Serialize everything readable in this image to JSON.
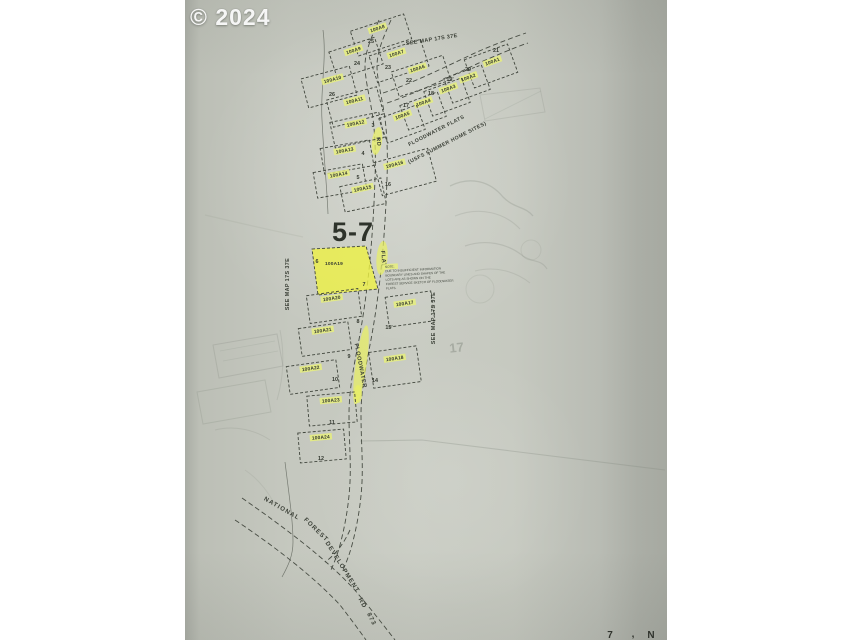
{
  "watermark": "© 2024",
  "colors": {
    "highlight": "#e6ee7c",
    "bright_highlight": "#edf143",
    "paper": "#c6c9c0",
    "ink": "#41463d"
  },
  "map": {
    "map_number": {
      "text": "5-7",
      "x": 168,
      "y": 241
    },
    "title": {
      "line1": {
        "text": "FLOODWATER FLATS",
        "x": 252,
        "y": 132,
        "rot": -27
      },
      "line2": {
        "text": "(USFS  SUMMER  HOME  SITES)",
        "x": 263,
        "y": 144,
        "rot": -27
      }
    },
    "see_map_references": [
      {
        "text": "SEE MAP 17S 37E",
        "x": 247,
        "y": 41,
        "rot": -9
      },
      {
        "text": "SEE MAP 17S 37E",
        "x": 104,
        "y": 284,
        "rot": -90
      },
      {
        "text": "SEE MAP 17S 37E",
        "x": 250,
        "y": 318,
        "rot": -90
      }
    ],
    "road_name_segments": [
      {
        "text": "RD",
        "x": 192,
        "y": 142,
        "rot": 82
      },
      {
        "text": "FLAT",
        "x": 197,
        "y": 259,
        "rot": 84
      },
      {
        "text": "FLOODWATER",
        "x": 174,
        "y": 366,
        "rot": 79
      }
    ],
    "forest_road_words": [
      {
        "text": "NATIONAL",
        "x": 96,
        "y": 510,
        "rot": 30
      },
      {
        "text": "FOREST",
        "x": 130,
        "y": 531,
        "rot": 44
      },
      {
        "text": "DEVELOPMENT",
        "x": 156,
        "y": 568,
        "rot": 58
      },
      {
        "text": "RD",
        "x": 176,
        "y": 604,
        "rot": 62
      },
      {
        "text": "873",
        "x": 185,
        "y": 620,
        "rot": 64
      }
    ],
    "note": {
      "x": 200,
      "y": 268,
      "rot": -3,
      "lines": [
        "NOTE:",
        "DUE TO INSUFFICIENT INFORMATION",
        "BOUNDARY LINES AND SHAPES OF THE",
        "LOTS ARE AS SHOWN ON THE",
        "FOREST SERVICE SKETCH OF FLOODWATER",
        "FLATS."
      ]
    },
    "pencil_note": {
      "text": "17",
      "x": 272,
      "y": 352
    },
    "bottom_edge_marks": [
      {
        "text": "7",
        "x": 425,
        "y": 638
      },
      {
        "text": ",",
        "x": 448,
        "y": 637
      },
      {
        "text": "N",
        "x": 466,
        "y": 638
      }
    ],
    "lots": [
      {
        "label": "100A8",
        "cx": 196,
        "cy": 35,
        "w": 56,
        "h": 26,
        "rot": -18,
        "lx": 193,
        "ly": 30,
        "nums": [
          {
            "t": "25",
            "x": 186,
            "y": 43
          }
        ]
      },
      {
        "label": "100A9",
        "cx": 171,
        "cy": 58,
        "w": 48,
        "h": 28,
        "rot": -18,
        "lx": 169,
        "ly": 52,
        "nums": [
          {
            "t": "24",
            "x": 172,
            "y": 65
          }
        ]
      },
      {
        "label": "100A7",
        "cx": 214,
        "cy": 61,
        "w": 54,
        "h": 28,
        "rot": -18,
        "lx": 212,
        "ly": 55,
        "nums": [
          {
            "t": "23",
            "x": 203,
            "y": 69
          }
        ]
      },
      {
        "label": "100A6",
        "cx": 236,
        "cy": 76,
        "w": 54,
        "h": 26,
        "rot": -18,
        "lx": 233,
        "ly": 70,
        "nums": [
          {
            "t": "22",
            "x": 224,
            "y": 82
          }
        ]
      },
      {
        "label": "100A1",
        "cx": 306,
        "cy": 66,
        "w": 46,
        "h": 30,
        "rot": -20,
        "lx": 308,
        "ly": 63,
        "nums": [
          {
            "t": "21",
            "x": 311,
            "y": 52
          }
        ]
      },
      {
        "label": "100A2",
        "cx": 282,
        "cy": 84,
        "w": 40,
        "h": 26,
        "rot": -20,
        "lx": 284,
        "ly": 79,
        "nums": [
          {
            "t": "20",
            "x": 283,
            "y": 71
          }
        ]
      },
      {
        "label": "100A3",
        "cx": 262,
        "cy": 97,
        "w": 40,
        "h": 26,
        "rot": -20,
        "lx": 264,
        "ly": 90,
        "nums": [
          {
            "t": "19'",
            "x": 265,
            "y": 81
          }
        ]
      },
      {
        "label": "100A4",
        "cx": 238,
        "cy": 111,
        "w": 40,
        "h": 26,
        "rot": -20,
        "lx": 239,
        "ly": 104,
        "nums": [
          {
            "t": "18",
            "x": 246,
            "y": 95
          }
        ]
      },
      {
        "label": "100A5",
        "cx": 217,
        "cy": 124,
        "w": 40,
        "h": 26,
        "rot": -20,
        "lx": 218,
        "ly": 117,
        "nums": [
          {
            "t": "17",
            "x": 221,
            "y": 107
          }
        ]
      },
      {
        "label": "100A10",
        "cx": 144,
        "cy": 87,
        "w": 50,
        "h": 30,
        "rot": -15,
        "lx": 148,
        "ly": 81,
        "nums": [
          {
            "t": "26",
            "x": 147,
            "y": 96
          }
        ]
      },
      {
        "label": "100A11",
        "cx": 170,
        "cy": 107,
        "w": 52,
        "h": 28,
        "rot": -15,
        "lx": 170,
        "ly": 102,
        "nums": []
      },
      {
        "label": "100A12",
        "cx": 172,
        "cy": 130,
        "w": 50,
        "h": 26,
        "rot": -12,
        "lx": 171,
        "ly": 125,
        "nums": [
          {
            "t": "3",
            "x": 188,
            "y": 127
          }
        ]
      },
      {
        "label": "100A13",
        "cx": 162,
        "cy": 157,
        "w": 50,
        "h": 26,
        "rot": -10,
        "lx": 160,
        "ly": 152,
        "nums": [
          {
            "t": "4",
            "x": 178,
            "y": 155
          }
        ]
      },
      {
        "label": "100A14",
        "cx": 155,
        "cy": 181,
        "w": 50,
        "h": 26,
        "rot": -10,
        "lx": 154,
        "ly": 176,
        "nums": [
          {
            "t": "5",
            "x": 173,
            "y": 179
          }
        ]
      },
      {
        "label": "100A15",
        "cx": 178,
        "cy": 195,
        "w": 42,
        "h": 26,
        "rot": -12,
        "lx": 178,
        "ly": 190,
        "nums": []
      },
      {
        "label": "100A16",
        "cx": 220,
        "cy": 172,
        "w": 56,
        "h": 34,
        "rot": -15,
        "lx": 210,
        "ly": 166,
        "nums": [
          {
            "t": "16",
            "x": 203,
            "y": 186
          }
        ]
      },
      {
        "label": "100A19",
        "points": "127,249 181,246 193,289 133,295",
        "bright": true,
        "lx": 149,
        "ly": 265,
        "nums": [
          {
            "t": "6",
            "x": 132,
            "y": 263
          },
          {
            "t": "7",
            "x": 179,
            "y": 286
          }
        ]
      },
      {
        "label": "100A20",
        "cx": 149,
        "cy": 306,
        "w": 52,
        "h": 28,
        "rot": -8,
        "lx": 147,
        "ly": 300,
        "nums": [
          {
            "t": "8",
            "x": 173,
            "y": 323
          }
        ]
      },
      {
        "label": "100A17",
        "cx": 225,
        "cy": 309,
        "w": 46,
        "h": 30,
        "rot": -8,
        "lx": 220,
        "ly": 305,
        "nums": [
          {
            "t": "15'",
            "x": 204,
            "y": 329
          }
        ]
      },
      {
        "label": "100A21",
        "cx": 140,
        "cy": 339,
        "w": 50,
        "h": 28,
        "rot": -8,
        "lx": 138,
        "ly": 332,
        "nums": [
          {
            "t": "9",
            "x": 164,
            "y": 358
          }
        ]
      },
      {
        "label": "100A18",
        "cx": 210,
        "cy": 367,
        "w": 48,
        "h": 36,
        "rot": -8,
        "lx": 210,
        "ly": 360,
        "nums": [
          {
            "t": "14",
            "x": 190,
            "y": 382
          }
        ]
      },
      {
        "label": "100A22",
        "cx": 128,
        "cy": 377,
        "w": 50,
        "h": 28,
        "rot": -8,
        "lx": 126,
        "ly": 370,
        "nums": [
          {
            "t": "10",
            "x": 150,
            "y": 381
          }
        ]
      },
      {
        "label": "100A23",
        "cx": 147,
        "cy": 409,
        "w": 48,
        "h": 30,
        "rot": -5,
        "lx": 146,
        "ly": 402,
        "nums": [
          {
            "t": "11",
            "x": 147,
            "y": 424
          }
        ]
      },
      {
        "label": "100A24",
        "cx": 137,
        "cy": 446,
        "w": 46,
        "h": 30,
        "rot": -5,
        "lx": 136,
        "ly": 439,
        "nums": [
          {
            "t": "12",
            "x": 136,
            "y": 460
          }
        ]
      }
    ]
  }
}
